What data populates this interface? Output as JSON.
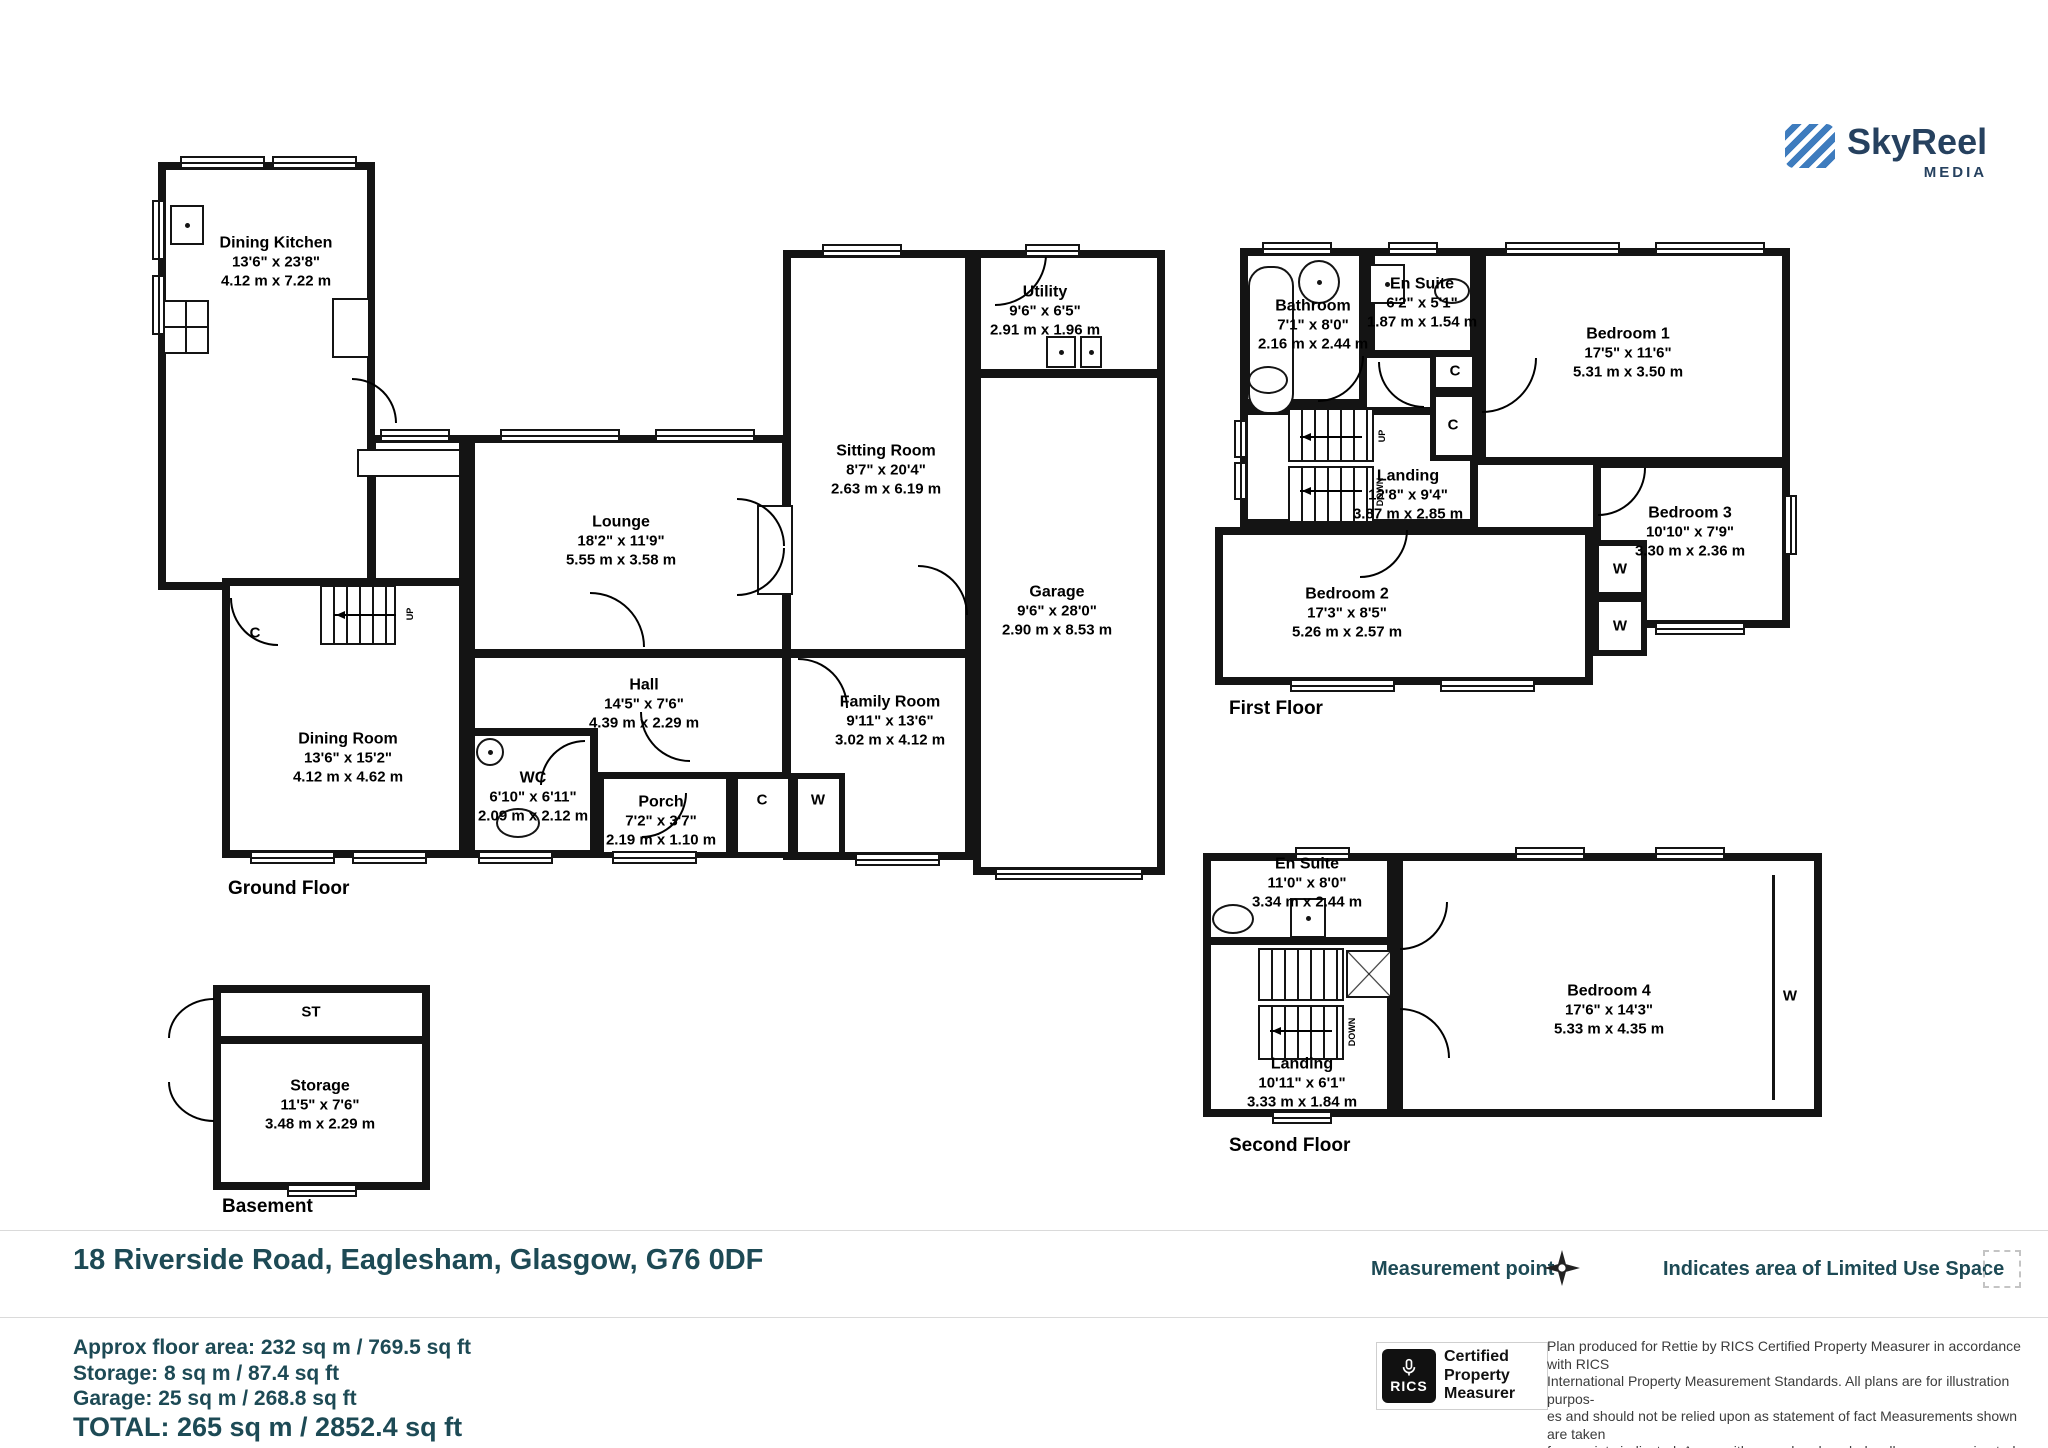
{
  "logo": {
    "name": "SkyReel",
    "tagline": "MEDIA"
  },
  "floors": {
    "ground": "Ground Floor",
    "first": "First Floor",
    "second": "Second Floor",
    "basement": "Basement"
  },
  "rooms": {
    "dining_kitchen": {
      "n": "Dining Kitchen",
      "f": "13'6\" x 23'8\"",
      "m": "4.12 m x 7.22 m"
    },
    "lounge": {
      "n": "Lounge",
      "f": "18'2\" x 11'9\"",
      "m": "5.55 m x 3.58 m"
    },
    "sitting": {
      "n": "Sitting Room",
      "f": "8'7\" x 20'4\"",
      "m": "2.63 m x 6.19 m"
    },
    "utility": {
      "n": "Utility",
      "f": "9'6\" x 6'5\"",
      "m": "2.91 m x 1.96 m"
    },
    "garage": {
      "n": "Garage",
      "f": "9'6\" x 28'0\"",
      "m": "2.90 m x 8.53 m"
    },
    "family": {
      "n": "Family Room",
      "f": "9'11\" x 13'6\"",
      "m": "3.02 m x 4.12 m"
    },
    "hall": {
      "n": "Hall",
      "f": "14'5\" x 7'6\"",
      "m": "4.39 m x 2.29 m"
    },
    "wc": {
      "n": "WC",
      "f": "6'10\" x 6'11\"",
      "m": "2.09 m x 2.12 m"
    },
    "porch": {
      "n": "Porch",
      "f": "7'2\" x 3'7\"",
      "m": "2.19 m x 1.10 m"
    },
    "dining": {
      "n": "Dining Room",
      "f": "13'6\" x 15'2\"",
      "m": "4.12 m x 4.62 m"
    },
    "bathroom": {
      "n": "Bathroom",
      "f": "7'1\" x 8'0\"",
      "m": "2.16 m x 2.44 m"
    },
    "ensuite1": {
      "n": "En Suite",
      "f": "6'2\" x 5'1\"",
      "m": "1.87 m x 1.54 m"
    },
    "bed1": {
      "n": "Bedroom 1",
      "f": "17'5\" x 11'6\"",
      "m": "5.31 m x 3.50 m"
    },
    "landing1": {
      "n": "Landing",
      "f": "12'8\" x 9'4\"",
      "m": "3.87 m x 2.85 m"
    },
    "bed2": {
      "n": "Bedroom 2",
      "f": "17'3\" x 8'5\"",
      "m": "5.26 m x 2.57 m"
    },
    "bed3": {
      "n": "Bedroom 3",
      "f": "10'10\" x 7'9\"",
      "m": "3.30 m x 2.36 m"
    },
    "ensuite2": {
      "n": "En Suite",
      "f": "11'0\" x 8'0\"",
      "m": "3.34 m x 2.44 m"
    },
    "bed4": {
      "n": "Bedroom 4",
      "f": "17'6\" x 14'3\"",
      "m": "5.33 m x 4.35 m"
    },
    "landing2": {
      "n": "Landing",
      "f": "10'11\" x 6'1\"",
      "m": "3.33 m x 1.84 m"
    },
    "storage": {
      "n": "Storage",
      "f": "11'5\" x 7'6\"",
      "m": "3.48 m x 2.29 m"
    }
  },
  "markers": {
    "c": "C",
    "w": "W",
    "st": "ST",
    "up": "UP",
    "down": "DOWN"
  },
  "address": "18 Riverside Road, Eaglesham, Glasgow, G76 0DF",
  "legend": {
    "measurement_point": "Measurement point",
    "measurement_point_icon": "four-pointed-star",
    "limited_use": "Indicates area of  Limited Use Space",
    "limited_use_icon": "dashed-square"
  },
  "summary": {
    "area": "Approx floor area: 232 sq m / 769.5 sq ft",
    "storage": "Storage: 8 sq m / 87.4 sq ft",
    "garage": "Garage:  25 sq m / 268.8 sq ft",
    "total": "TOTAL: 265 sq m / 2852.4 sq ft"
  },
  "rics": {
    "logo_text": "RICS",
    "lines": [
      "Certified",
      "Property",
      "Measurer"
    ]
  },
  "disclaimer": [
    "Plan produced for Rettie by RICS Certified Property Measurer in accordance with RICS",
    "International Property  Measurement Standards.  All plans are for illustration purpos-",
    "es and should not be relied upon as statement of fact Measurements shown are taken",
    "from points indicated. Areas with curved and angled walls are approximated."
  ]
}
